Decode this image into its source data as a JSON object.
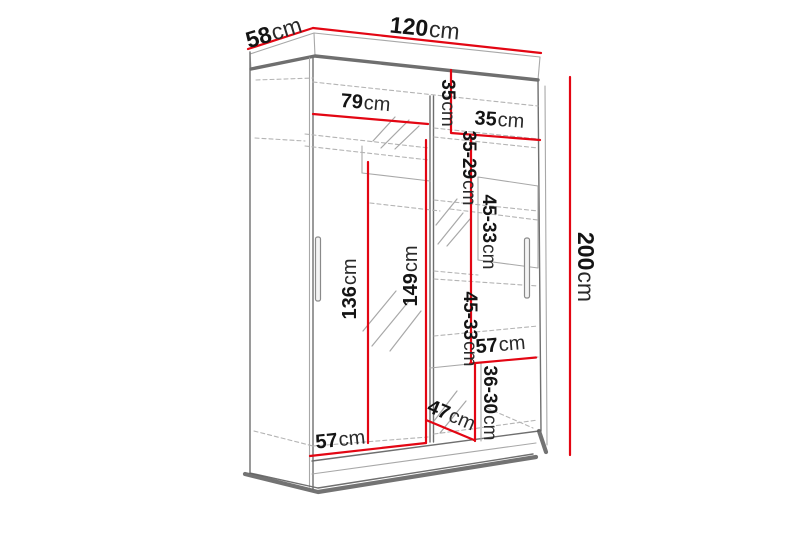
{
  "diagram": {
    "kind": "wardrobe-dimension-diagram",
    "unit": "cm",
    "colors": {
      "dimension": "#e30613",
      "edge": "#6f6f6f",
      "edge_light": "#a8a8a8",
      "dashed": "#b4b4b4",
      "shadow": "#5a5a5a",
      "label": "#141414",
      "unit": "#2a2a2a",
      "background": "#ffffff"
    },
    "labels": {
      "depth": {
        "value": "58",
        "unit": "cm"
      },
      "width": {
        "value": "120",
        "unit": "cm"
      },
      "height": {
        "value": "200",
        "unit": "cm"
      },
      "rail_width": {
        "value": "79",
        "unit": "cm"
      },
      "top_section_height": {
        "value": "35",
        "unit": "cm"
      },
      "top_shelf_width": {
        "value": "35",
        "unit": "cm"
      },
      "gap_35_29": {
        "value": "35-29",
        "unit": "cm"
      },
      "gap_45_33_upper": {
        "value": "45-33",
        "unit": "cm"
      },
      "left_section_height": {
        "value": "136",
        "unit": "cm"
      },
      "right_section_height": {
        "value": "149",
        "unit": "cm"
      },
      "gap_45_33_lower": {
        "value": "45-33",
        "unit": "cm"
      },
      "shelf_width_upper": {
        "value": "57",
        "unit": "cm"
      },
      "gap_36_30": {
        "value": "36-30",
        "unit": "cm"
      },
      "shelf_depth": {
        "value": "47",
        "unit": "cm"
      },
      "shelf_width_lower": {
        "value": "57",
        "unit": "cm"
      }
    }
  }
}
